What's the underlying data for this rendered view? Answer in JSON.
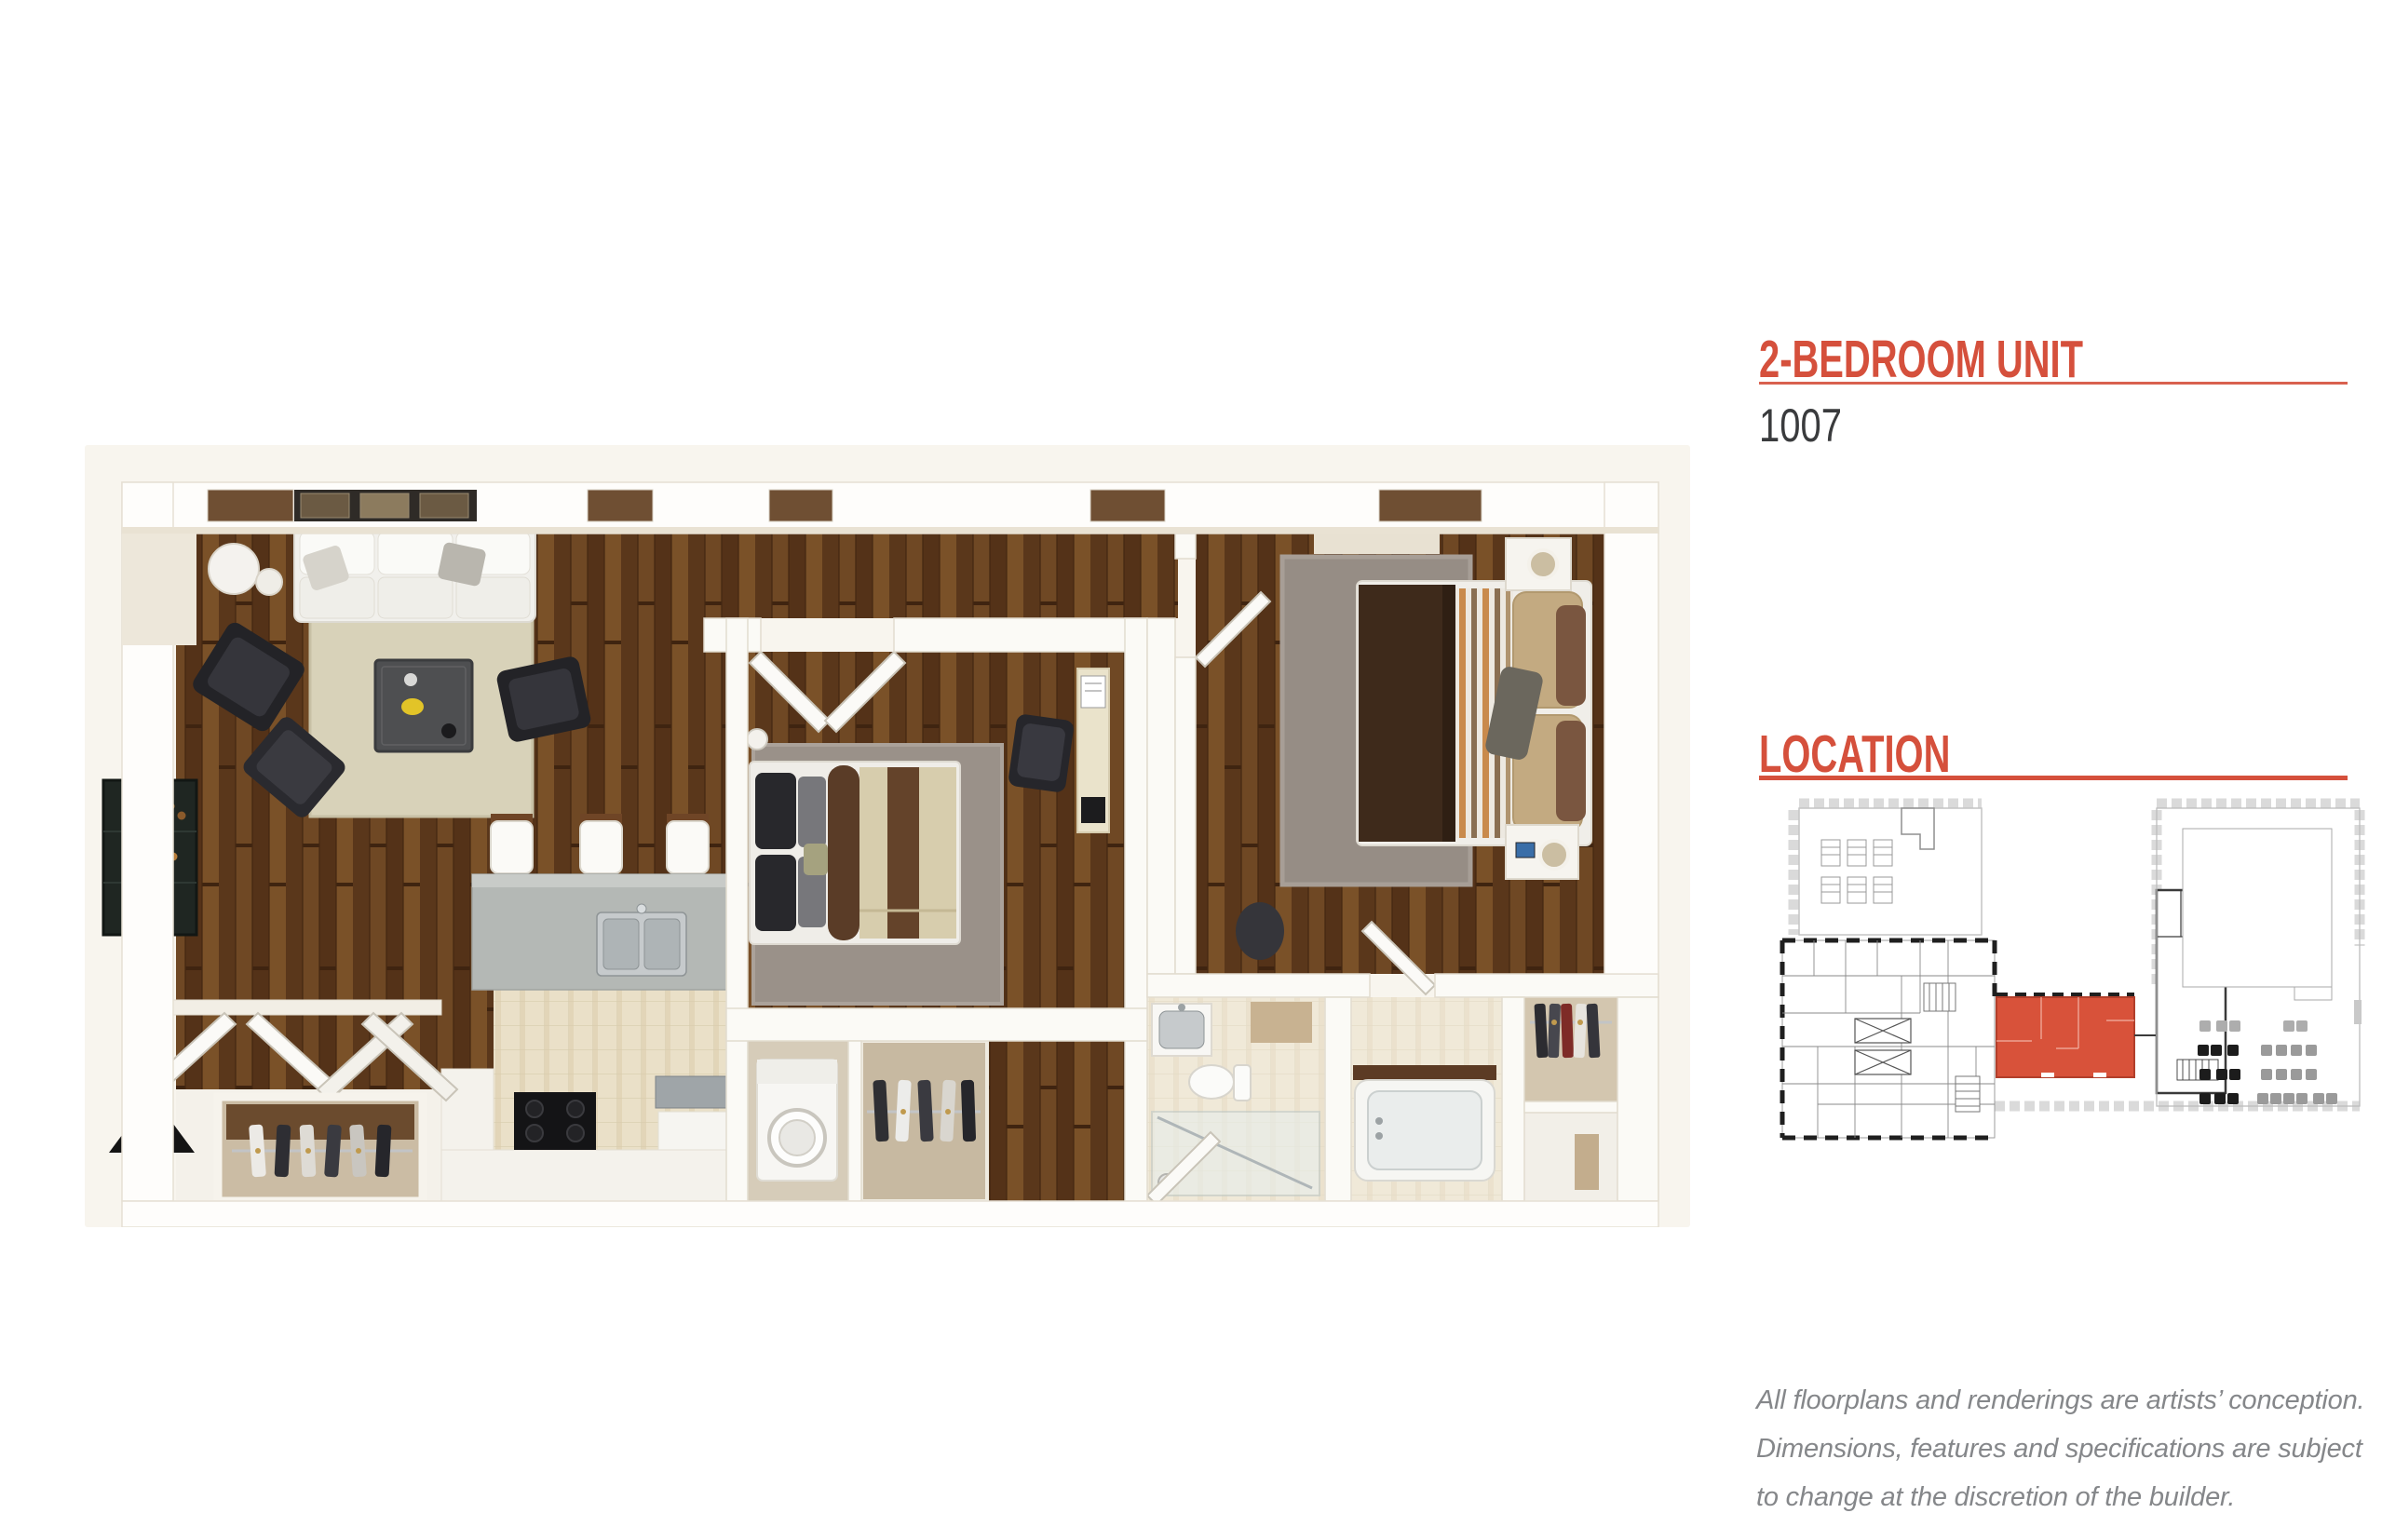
{
  "header": {
    "unit_heading": "2-BEDROOM UNIT",
    "unit_number": "1007",
    "location_heading": "LOCATION"
  },
  "disclaimer_lines": [
    "All floorplans and renderings are artists’ conception.",
    "Dimensions, features and specifications are subject",
    "to change at the discretion of the builder."
  ],
  "colors": {
    "accent": "#D5503C",
    "unit_number": "#3A3B3D",
    "disclaimer": "#85878A",
    "map_highlight": "#D8523A",
    "plan_background": "#F8F5EE",
    "wood_floor": "#66412A",
    "tile_floor": "#EAE0C8",
    "rug_beige": "#D8D2B9",
    "rug_gray": "#978E85",
    "wall_white": "#FEFDFB"
  }
}
